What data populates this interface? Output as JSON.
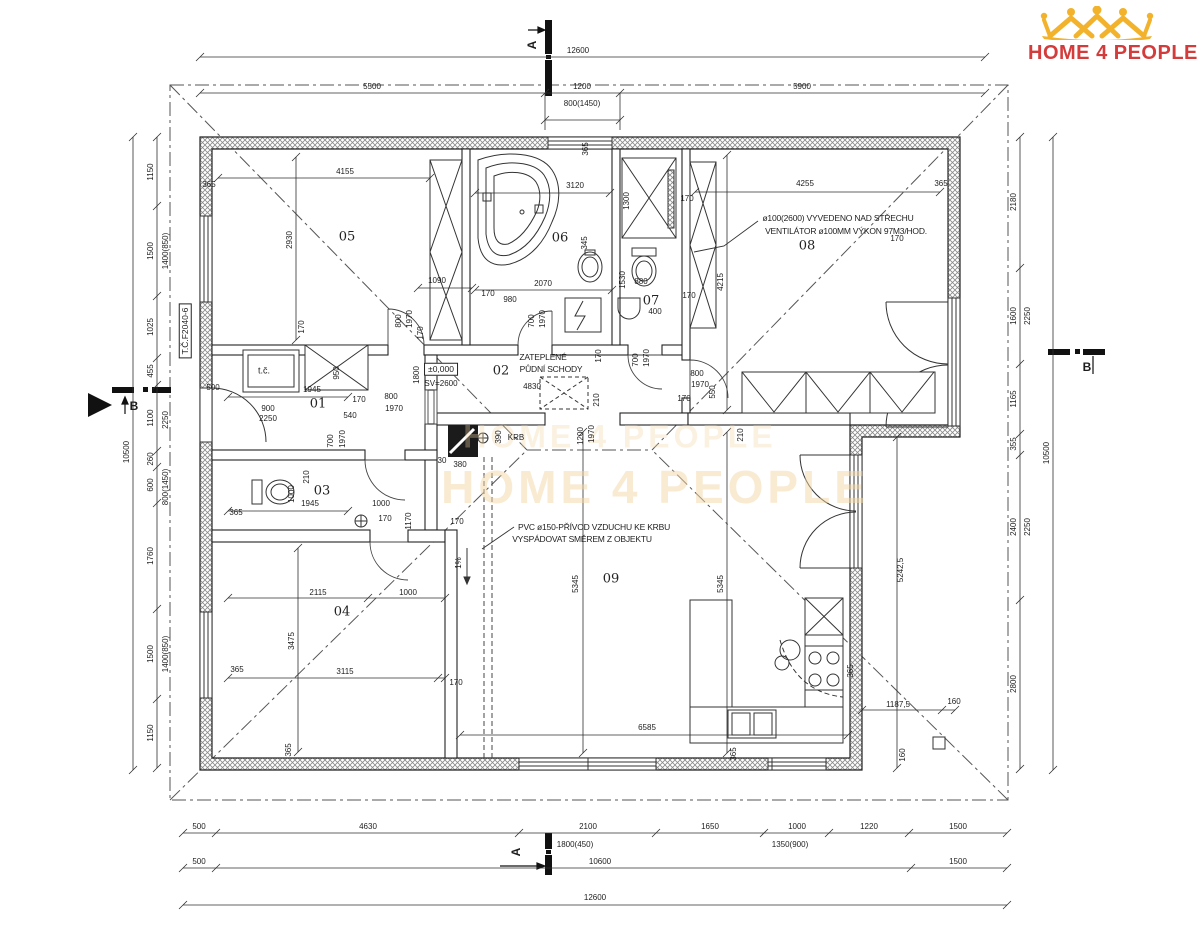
{
  "brand": {
    "word1": "HOME",
    "word2": "4",
    "word3": "PEOPLE",
    "red": "#d43b3b",
    "gold": "#f2b22b"
  },
  "watermark": {
    "line1": "HOME 4 PEOPLE",
    "line2": "HOME 4 PEOPLE"
  },
  "rooms": [
    {
      "t": "01",
      "x": 318,
      "y": 404
    },
    {
      "t": "02",
      "x": 501,
      "y": 371
    },
    {
      "t": "03",
      "x": 322,
      "y": 491
    },
    {
      "t": "04",
      "x": 342,
      "y": 612
    },
    {
      "t": "05",
      "x": 347,
      "y": 237
    },
    {
      "t": "06",
      "x": 560,
      "y": 238
    },
    {
      "t": "07",
      "x": 651,
      "y": 301
    },
    {
      "t": "08",
      "x": 807,
      "y": 246
    },
    {
      "t": "09",
      "x": 611,
      "y": 579
    }
  ],
  "labels": [
    {
      "t": "12600",
      "x": 578,
      "y": 51
    },
    {
      "t": "5500",
      "x": 372,
      "y": 87
    },
    {
      "t": "1200",
      "x": 582,
      "y": 87
    },
    {
      "t": "5900",
      "x": 802,
      "y": 87
    },
    {
      "t": "800(1450)",
      "x": 582,
      "y": 104
    },
    {
      "t": "10500",
      "x": 127,
      "y": 452,
      "r": 1
    },
    {
      "t": "1150",
      "x": 151,
      "y": 172,
      "r": 1
    },
    {
      "t": "1500",
      "x": 151,
      "y": 251,
      "r": 1
    },
    {
      "t": "1400(850)",
      "x": 166,
      "y": 251,
      "r": 1
    },
    {
      "t": "1025",
      "x": 151,
      "y": 327,
      "r": 1
    },
    {
      "t": "455",
      "x": 151,
      "y": 371,
      "r": 1
    },
    {
      "t": "1100",
      "x": 151,
      "y": 418,
      "r": 1
    },
    {
      "t": "2250",
      "x": 166,
      "y": 420,
      "r": 1
    },
    {
      "t": "260",
      "x": 151,
      "y": 459,
      "r": 1
    },
    {
      "t": "600",
      "x": 151,
      "y": 485,
      "r": 1
    },
    {
      "t": "800(1450)",
      "x": 166,
      "y": 487,
      "r": 1
    },
    {
      "t": "1760",
      "x": 151,
      "y": 556,
      "r": 1
    },
    {
      "t": "1500",
      "x": 151,
      "y": 654,
      "r": 1
    },
    {
      "t": "1400(850)",
      "x": 166,
      "y": 654,
      "r": 1
    },
    {
      "t": "1150",
      "x": 151,
      "y": 733,
      "r": 1
    },
    {
      "t": "10500",
      "x": 1047,
      "y": 453,
      "r": 1
    },
    {
      "t": "2180",
      "x": 1014,
      "y": 202,
      "r": 1
    },
    {
      "t": "1600",
      "x": 1014,
      "y": 316,
      "r": 1
    },
    {
      "t": "2250",
      "x": 1028,
      "y": 316,
      "r": 1
    },
    {
      "t": "1165",
      "x": 1014,
      "y": 399,
      "r": 1
    },
    {
      "t": "355",
      "x": 1014,
      "y": 444,
      "r": 1
    },
    {
      "t": "2400",
      "x": 1014,
      "y": 527,
      "r": 1
    },
    {
      "t": "2250",
      "x": 1028,
      "y": 527,
      "r": 1
    },
    {
      "t": "2800",
      "x": 1014,
      "y": 684,
      "r": 1
    },
    {
      "t": "500",
      "x": 199,
      "y": 827
    },
    {
      "t": "4630",
      "x": 368,
      "y": 827
    },
    {
      "t": "2100",
      "x": 588,
      "y": 827
    },
    {
      "t": "1650",
      "x": 710,
      "y": 827
    },
    {
      "t": "1000",
      "x": 797,
      "y": 827
    },
    {
      "t": "1220",
      "x": 869,
      "y": 827
    },
    {
      "t": "1500",
      "x": 958,
      "y": 827
    },
    {
      "t": "1800(450)",
      "x": 575,
      "y": 845
    },
    {
      "t": "1350(900)",
      "x": 790,
      "y": 845
    },
    {
      "t": "500",
      "x": 199,
      "y": 862
    },
    {
      "t": "10600",
      "x": 600,
      "y": 862
    },
    {
      "t": "1500",
      "x": 958,
      "y": 862
    },
    {
      "t": "12600",
      "x": 595,
      "y": 898
    },
    {
      "t": "365",
      "x": 209,
      "y": 185
    },
    {
      "t": "4155",
      "x": 345,
      "y": 172
    },
    {
      "t": "2930",
      "x": 290,
      "y": 240,
      "r": 1
    },
    {
      "t": "170",
      "x": 302,
      "y": 327,
      "r": 1
    },
    {
      "t": "1090",
      "x": 437,
      "y": 281
    },
    {
      "t": "800",
      "x": 399,
      "y": 321,
      "r": 1
    },
    {
      "t": "1970",
      "x": 410,
      "y": 319,
      "r": 1
    },
    {
      "t": "170",
      "x": 421,
      "y": 333,
      "r": 1
    },
    {
      "t": "500",
      "x": 213,
      "y": 388
    },
    {
      "t": "1945",
      "x": 312,
      "y": 390
    },
    {
      "t": "365",
      "x": 586,
      "y": 149,
      "r": 1
    },
    {
      "t": "3120",
      "x": 575,
      "y": 186
    },
    {
      "t": "1300",
      "x": 627,
      "y": 201,
      "r": 1
    },
    {
      "t": "345",
      "x": 585,
      "y": 243,
      "r": 1
    },
    {
      "t": "2070",
      "x": 543,
      "y": 284
    },
    {
      "t": "170",
      "x": 488,
      "y": 294
    },
    {
      "t": "980",
      "x": 510,
      "y": 300
    },
    {
      "t": "700",
      "x": 532,
      "y": 321,
      "r": 1
    },
    {
      "t": "1970",
      "x": 543,
      "y": 319,
      "r": 1
    },
    {
      "t": "170",
      "x": 599,
      "y": 356,
      "r": 1
    },
    {
      "t": "1530",
      "x": 623,
      "y": 280,
      "r": 1
    },
    {
      "t": "880",
      "x": 641,
      "y": 282
    },
    {
      "t": "400",
      "x": 655,
      "y": 312
    },
    {
      "t": "170",
      "x": 687,
      "y": 199
    },
    {
      "t": "170",
      "x": 689,
      "y": 296
    },
    {
      "t": "700",
      "x": 636,
      "y": 360,
      "r": 1
    },
    {
      "t": "1970",
      "x": 647,
      "y": 358,
      "r": 1
    },
    {
      "t": "170",
      "x": 684,
      "y": 399
    },
    {
      "t": "800",
      "x": 697,
      "y": 374
    },
    {
      "t": "1970",
      "x": 700,
      "y": 385
    },
    {
      "t": "550",
      "x": 713,
      "y": 392,
      "r": 1
    },
    {
      "t": "4255",
      "x": 805,
      "y": 184
    },
    {
      "t": "365",
      "x": 941,
      "y": 184
    },
    {
      "t": "4215",
      "x": 721,
      "y": 282,
      "r": 1
    },
    {
      "t": "170",
      "x": 897,
      "y": 239
    },
    {
      "t": "900",
      "x": 268,
      "y": 409
    },
    {
      "t": "2250",
      "x": 268,
      "y": 419
    },
    {
      "t": "540",
      "x": 350,
      "y": 416
    },
    {
      "t": "950",
      "x": 337,
      "y": 373,
      "r": 1
    },
    {
      "t": "1800",
      "x": 417,
      "y": 375,
      "r": 1
    },
    {
      "t": "170",
      "x": 359,
      "y": 400
    },
    {
      "t": "800",
      "x": 391,
      "y": 397
    },
    {
      "t": "1970",
      "x": 394,
      "y": 409
    },
    {
      "t": "700",
      "x": 331,
      "y": 441,
      "r": 1
    },
    {
      "t": "1970",
      "x": 343,
      "y": 439,
      "r": 1
    },
    {
      "t": "210",
      "x": 307,
      "y": 477,
      "r": 1
    },
    {
      "t": "4830",
      "x": 532,
      "y": 387
    },
    {
      "t": "210",
      "x": 597,
      "y": 400,
      "r": 1
    },
    {
      "t": "1200",
      "x": 581,
      "y": 436,
      "r": 1
    },
    {
      "t": "1970",
      "x": 592,
      "y": 434,
      "r": 1
    },
    {
      "t": "210",
      "x": 741,
      "y": 435,
      "r": 1
    },
    {
      "t": "1000",
      "x": 292,
      "y": 494,
      "r": 1
    },
    {
      "t": "1945",
      "x": 310,
      "y": 504
    },
    {
      "t": "1000",
      "x": 381,
      "y": 504
    },
    {
      "t": "1170",
      "x": 409,
      "y": 521,
      "r": 1
    },
    {
      "t": "170",
      "x": 385,
      "y": 519
    },
    {
      "t": "365",
      "x": 236,
      "y": 513
    },
    {
      "t": "2115",
      "x": 318,
      "y": 593
    },
    {
      "t": "1000",
      "x": 408,
      "y": 593
    },
    {
      "t": "3475",
      "x": 292,
      "y": 641,
      "r": 1
    },
    {
      "t": "3115",
      "x": 345,
      "y": 672
    },
    {
      "t": "365",
      "x": 237,
      "y": 670
    },
    {
      "t": "170",
      "x": 456,
      "y": 683
    },
    {
      "t": "365",
      "x": 289,
      "y": 750,
      "r": 1
    },
    {
      "t": "5345",
      "x": 576,
      "y": 584,
      "r": 1
    },
    {
      "t": "5345",
      "x": 721,
      "y": 584,
      "r": 1
    },
    {
      "t": "6585",
      "x": 647,
      "y": 728
    },
    {
      "t": "170",
      "x": 457,
      "y": 522
    },
    {
      "t": "380",
      "x": 460,
      "y": 465
    },
    {
      "t": "30",
      "x": 442,
      "y": 461
    },
    {
      "t": "390",
      "x": 499,
      "y": 437,
      "r": 1
    },
    {
      "t": "1%",
      "x": 459,
      "y": 563,
      "r": 1
    },
    {
      "t": "5242,5",
      "x": 901,
      "y": 570,
      "r": 1
    },
    {
      "t": "1187,5",
      "x": 898,
      "y": 705
    },
    {
      "t": "160",
      "x": 954,
      "y": 702
    },
    {
      "t": "160",
      "x": 903,
      "y": 755,
      "r": 1
    },
    {
      "t": "365",
      "x": 851,
      "y": 671,
      "r": 1
    },
    {
      "t": "365",
      "x": 734,
      "y": 754,
      "r": 1
    },
    {
      "t": "KRB",
      "x": 516,
      "y": 438
    },
    {
      "t": "SV=2600",
      "x": 441,
      "y": 384
    }
  ],
  "marks": [
    {
      "t": "A",
      "x": 532,
      "y": 45,
      "r": 1
    },
    {
      "t": "A",
      "x": 516,
      "y": 852,
      "r": 1
    },
    {
      "t": "B",
      "x": 134,
      "y": 406
    },
    {
      "t": "B",
      "x": 1087,
      "y": 367
    }
  ],
  "boxes": [
    {
      "t": "±0,000",
      "x": 441,
      "y": 369
    },
    {
      "t": "T.Č.F2040-6",
      "x": 185,
      "y": 331,
      "r": 1
    }
  ],
  "units": [
    {
      "t": "t.č.",
      "x": 264,
      "y": 371
    }
  ],
  "notes": [
    {
      "t": "ø100(2600) VYVEDENO NAD STŘECHU",
      "x": 838,
      "y": 218
    },
    {
      "t": "VENTILÁTOR ø100MM VÝKON 97M3/HOD.",
      "x": 846,
      "y": 231
    },
    {
      "t": "PVC ø150-PŘÍVOD VZDUCHU KE KRBU",
      "x": 594,
      "y": 527
    },
    {
      "t": "VYSPÁDOVAT SMĚREM Z OBJEKTU",
      "x": 582,
      "y": 539
    },
    {
      "t": "ZATEPLENÉ",
      "x": 543,
      "y": 357
    },
    {
      "t": "PŮDNÍ SCHODY",
      "x": 551,
      "y": 369
    }
  ],
  "chains": [
    {
      "o": "h",
      "c": 57,
      "a": 200,
      "b": 985,
      "t": [
        200,
        985
      ]
    },
    {
      "o": "h",
      "c": 93,
      "a": 200,
      "b": 985,
      "t": [
        200,
        545,
        620,
        985
      ]
    },
    {
      "o": "h",
      "c": 120,
      "a": 545,
      "b": 620,
      "t": [
        545,
        620
      ]
    },
    {
      "o": "v",
      "c": 133,
      "a": 137,
      "b": 770,
      "t": [
        137,
        770
      ]
    },
    {
      "o": "v",
      "c": 157,
      "a": 137,
      "b": 768,
      "t": [
        137,
        206,
        296,
        358,
        385,
        451,
        467,
        503,
        609,
        699,
        768
      ]
    },
    {
      "o": "v",
      "c": 1053,
      "a": 137,
      "b": 770,
      "t": [
        137,
        770
      ]
    },
    {
      "o": "v",
      "c": 1020,
      "a": 137,
      "b": 769,
      "t": [
        137,
        268,
        364,
        434,
        455,
        600,
        769
      ]
    },
    {
      "o": "h",
      "c": 833,
      "a": 183,
      "b": 1007,
      "t": [
        183,
        216,
        519,
        656,
        764,
        829,
        909,
        1007
      ]
    },
    {
      "o": "h",
      "c": 868,
      "a": 183,
      "b": 1007,
      "t": [
        183,
        216,
        911,
        1007
      ]
    },
    {
      "o": "h",
      "c": 905,
      "a": 183,
      "b": 1007,
      "t": [
        183,
        1007
      ]
    },
    {
      "o": "h",
      "c": 178,
      "a": 218,
      "b": 430,
      "t": [
        218,
        430
      ]
    },
    {
      "o": "h",
      "c": 193,
      "a": 475,
      "b": 610,
      "t": [
        475,
        610
      ]
    },
    {
      "o": "h",
      "c": 192,
      "a": 695,
      "b": 940,
      "t": [
        695,
        940
      ]
    },
    {
      "o": "v",
      "c": 296,
      "a": 157,
      "b": 340,
      "t": [
        157,
        340
      ]
    },
    {
      "o": "v",
      "c": 727,
      "a": 155,
      "b": 410,
      "t": [
        155,
        410
      ]
    },
    {
      "o": "v",
      "c": 583,
      "a": 432,
      "b": 753,
      "t": [
        432,
        753
      ]
    },
    {
      "o": "v",
      "c": 727,
      "a": 432,
      "b": 753,
      "t": [
        432,
        753
      ]
    },
    {
      "o": "h",
      "c": 735,
      "a": 460,
      "b": 848,
      "t": [
        460,
        848
      ]
    },
    {
      "o": "h",
      "c": 598,
      "a": 228,
      "b": 445,
      "t": [
        228,
        368,
        445
      ]
    },
    {
      "o": "h",
      "c": 678,
      "a": 228,
      "b": 445,
      "t": [
        228,
        438,
        445
      ]
    },
    {
      "o": "v",
      "c": 298,
      "a": 548,
      "b": 752,
      "t": [
        548,
        752
      ]
    },
    {
      "o": "v",
      "c": 897,
      "a": 437,
      "b": 768,
      "t": [
        437,
        768
      ]
    },
    {
      "o": "h",
      "c": 710,
      "a": 862,
      "b": 955,
      "t": [
        862,
        942,
        955
      ]
    },
    {
      "o": "h",
      "c": 288,
      "a": 418,
      "b": 472,
      "t": [
        418,
        472
      ]
    },
    {
      "o": "h",
      "c": 290,
      "a": 475,
      "b": 612,
      "t": [
        475,
        612
      ]
    },
    {
      "o": "h",
      "c": 397,
      "a": 228,
      "b": 348,
      "t": [
        228,
        348
      ]
    },
    {
      "o": "h",
      "c": 511,
      "a": 228,
      "b": 348,
      "t": [
        228,
        348
      ]
    }
  ]
}
